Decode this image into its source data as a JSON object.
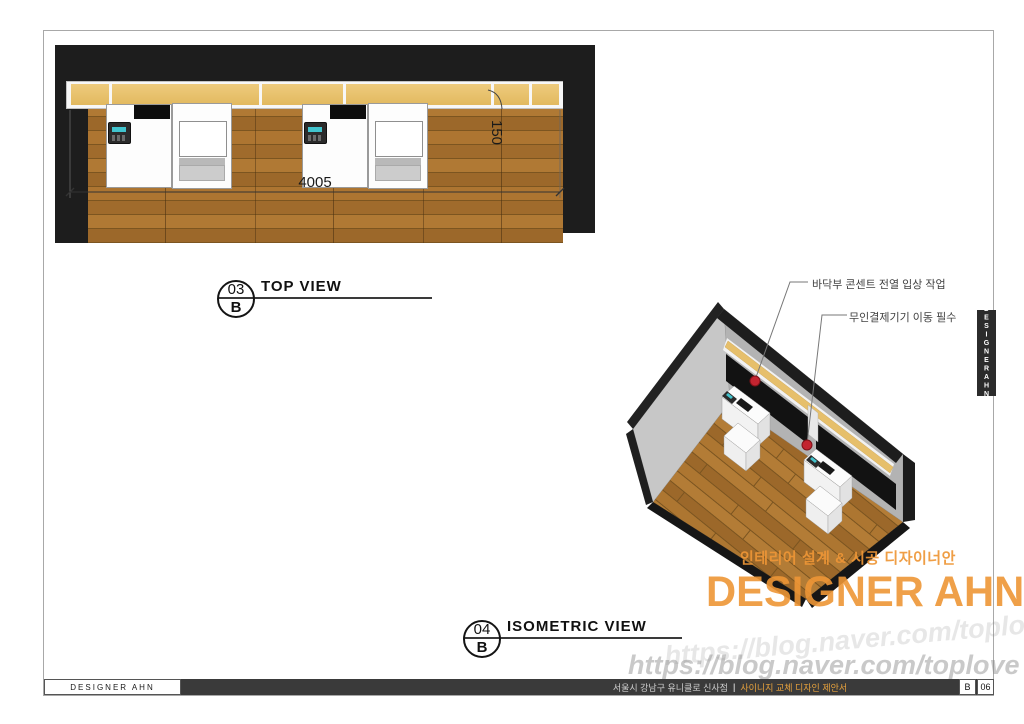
{
  "labels": {
    "top_view": {
      "number": "03",
      "row": "B",
      "title": "TOP VIEW"
    },
    "iso_view": {
      "number": "04",
      "row": "B",
      "title": "ISOMETRIC VIEW"
    }
  },
  "dimensions": {
    "counter_width": "4005",
    "shelf_depth": "150"
  },
  "annotations": {
    "outlet": "바닥부 콘센트 전열 입상 작업",
    "kiosk": "무인결제기기 이동 필수"
  },
  "watermark": {
    "tagline": "인테리어 설계 & 시공 디자이너안",
    "brand": "DESIGNER AHN",
    "url": "https://blog.naver.com/toplove"
  },
  "side_tab": {
    "text": "DESIGNERAHN"
  },
  "footer": {
    "brand": "DESIGNER AHN",
    "project": "서울시 강남구 유니클로 신사점",
    "separator": "|",
    "doc_title": "사이니지 교체 디자인 제안서",
    "sheet_row": "B",
    "sheet_no": "06"
  },
  "colors": {
    "accent_orange": "#ee9636",
    "wood_mid": "#a9722f",
    "shelf_tan": "#e6bf6b",
    "wall_black": "#1d1d1d",
    "wall_gray": "#b3b3b3",
    "marker_red": "#c32430",
    "footer_bg": "#3a3a3a",
    "footer_accent": "#e8a33d"
  }
}
